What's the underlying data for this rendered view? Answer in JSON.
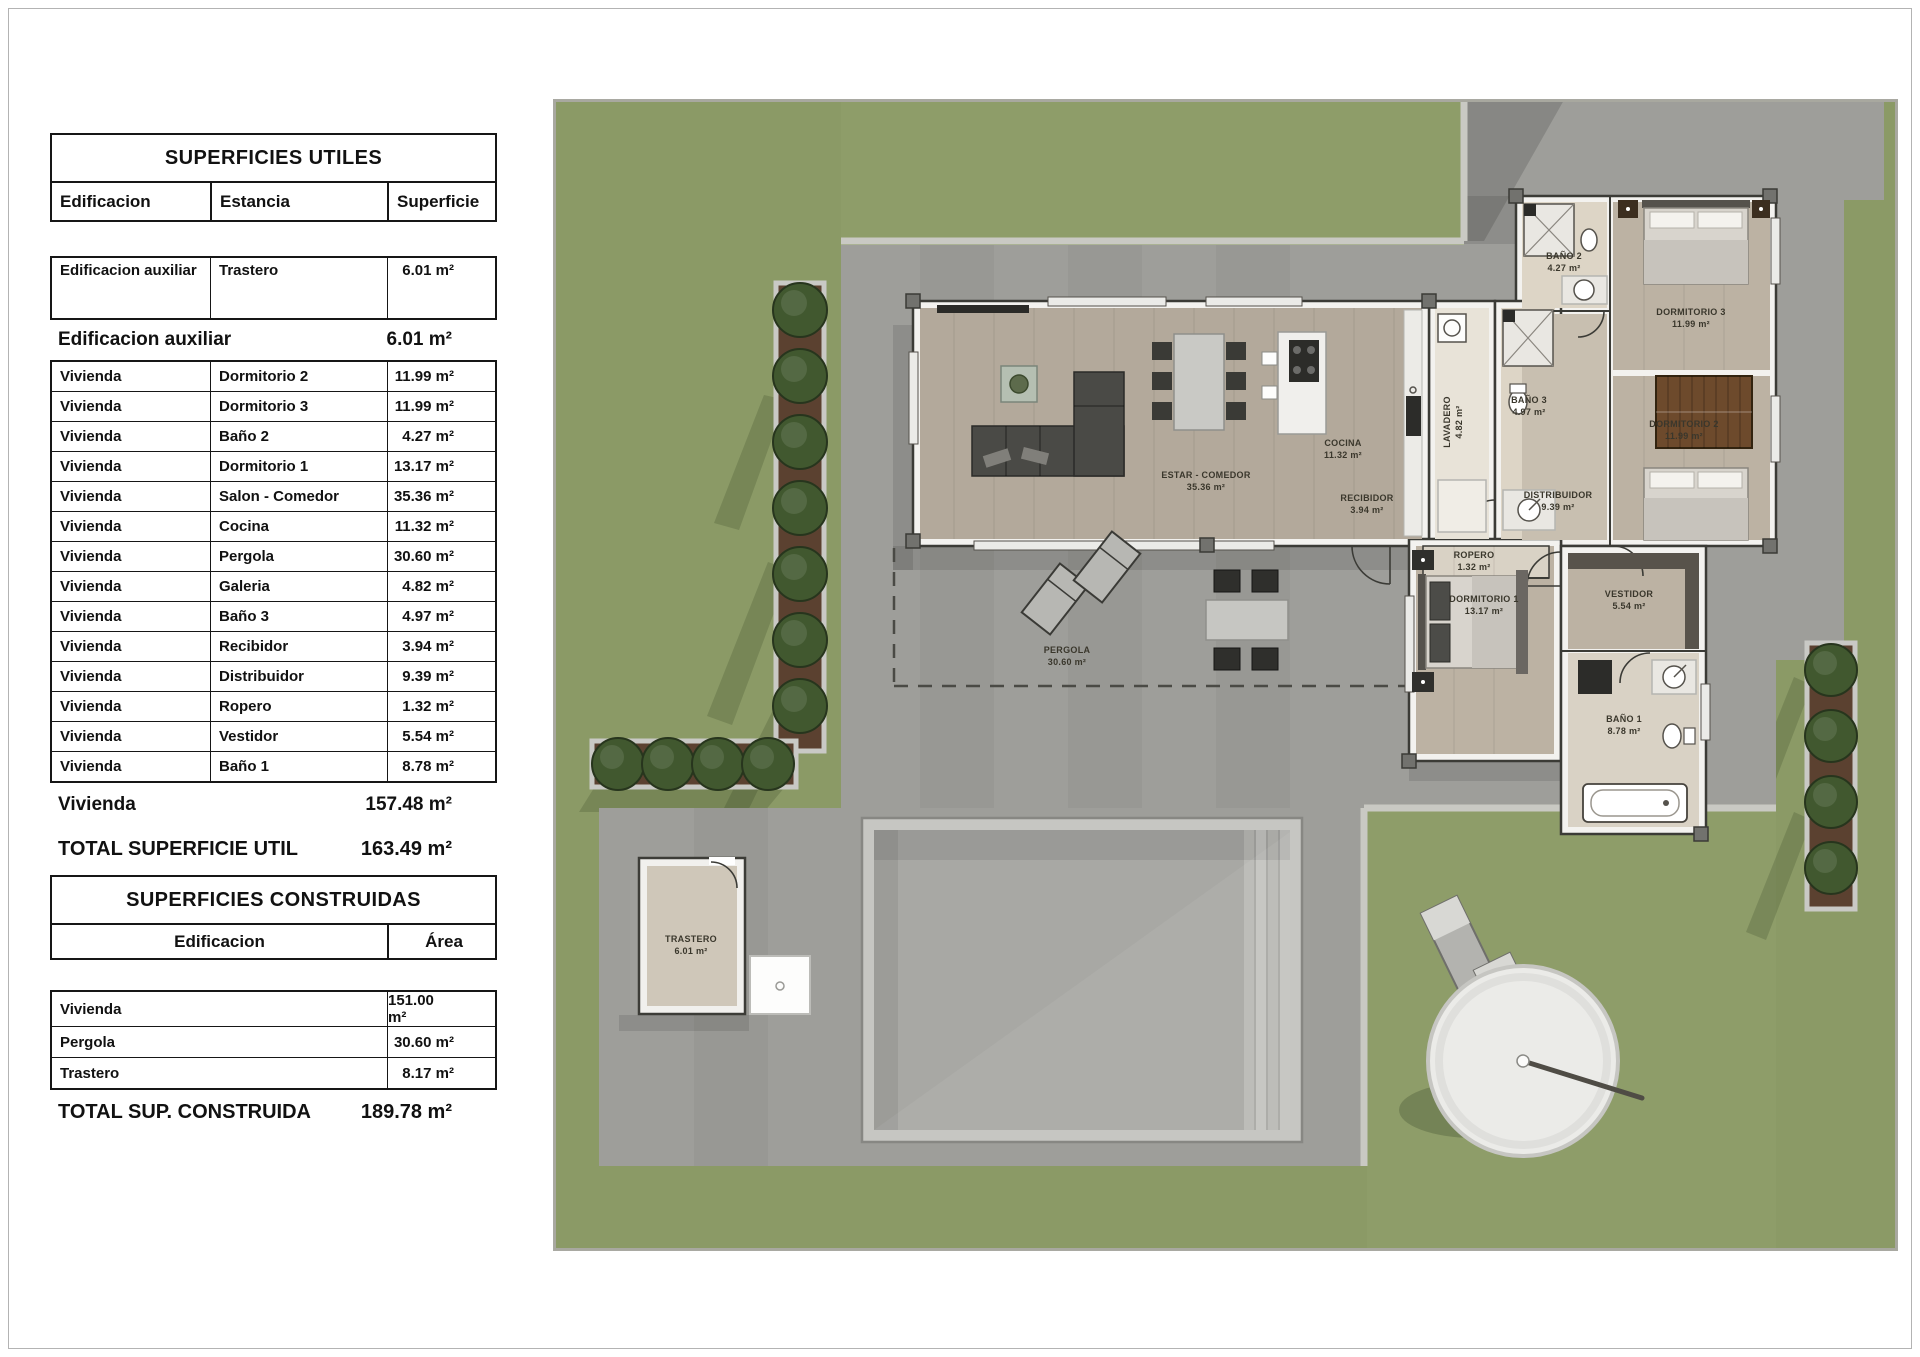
{
  "tables": {
    "utiles": {
      "title": "SUPERFICIES UTILES",
      "columns": [
        "Edificacion",
        "Estancia",
        "Superficie"
      ],
      "first_row": {
        "edificacion": "Edificacion auxiliar",
        "estancia": "Trastero",
        "superficie": "6.01 m²"
      },
      "subtotal_aux": {
        "label": "Edificacion auxiliar",
        "value": "6.01 m²"
      },
      "rows": [
        {
          "edificacion": "Vivienda",
          "estancia": "Dormitorio 2",
          "superficie": "11.99 m²"
        },
        {
          "edificacion": "Vivienda",
          "estancia": "Dormitorio 3",
          "superficie": "11.99 m²"
        },
        {
          "edificacion": "Vivienda",
          "estancia": "Baño 2",
          "superficie": "4.27 m²"
        },
        {
          "edificacion": "Vivienda",
          "estancia": "Dormitorio 1",
          "superficie": "13.17 m²"
        },
        {
          "edificacion": "Vivienda",
          "estancia": "Salon - Comedor",
          "superficie": "35.36 m²"
        },
        {
          "edificacion": "Vivienda",
          "estancia": "Cocina",
          "superficie": "11.32 m²"
        },
        {
          "edificacion": "Vivienda",
          "estancia": "Pergola",
          "superficie": "30.60 m²"
        },
        {
          "edificacion": "Vivienda",
          "estancia": "Galeria",
          "superficie": "4.82 m²"
        },
        {
          "edificacion": "Vivienda",
          "estancia": "Baño 3",
          "superficie": "4.97 m²"
        },
        {
          "edificacion": "Vivienda",
          "estancia": "Recibidor",
          "superficie": "3.94 m²"
        },
        {
          "edificacion": "Vivienda",
          "estancia": "Distribuidor",
          "superficie": "9.39 m²"
        },
        {
          "edificacion": "Vivienda",
          "estancia": "Ropero",
          "superficie": "1.32 m²"
        },
        {
          "edificacion": "Vivienda",
          "estancia": "Vestidor",
          "superficie": "5.54 m²"
        },
        {
          "edificacion": "Vivienda",
          "estancia": "Baño 1",
          "superficie": "8.78 m²"
        }
      ],
      "subtotal_vivienda": {
        "label": "Vivienda",
        "value": "157.48 m²"
      },
      "total": {
        "label": "TOTAL SUPERFICIE UTIL",
        "value": "163.49 m²"
      }
    },
    "construidas": {
      "title": "SUPERFICIES CONSTRUIDAS",
      "columns": [
        "Edificacion",
        "Área"
      ],
      "rows": [
        {
          "edificacion": "Vivienda",
          "area": "151.00 m²"
        },
        {
          "edificacion": "Pergola",
          "area": "30.60 m²"
        },
        {
          "edificacion": "Trastero",
          "area": "8.17 m²"
        }
      ],
      "total": {
        "label": "TOTAL SUP. CONSTRUIDA",
        "value": "189.78 m²"
      }
    }
  },
  "plan": {
    "colors": {
      "grass": "#8b9a66",
      "paving": "#9e9e9a",
      "wall": "#f3f2ef",
      "wood_floor": "#b3a99b",
      "bath_floor": "#ddd5c6",
      "tree": "#41582f",
      "planter": "#5b4130",
      "pool_water": "#a8a8a4"
    },
    "rooms": [
      {
        "label": "ESTAR - COMEDOR",
        "area": "35.36 m²"
      },
      {
        "label": "COCINA",
        "area": "11.32 m²"
      },
      {
        "label": "LAVADERO",
        "area": "4.82 m²"
      },
      {
        "label": "BAÑO 3",
        "area": "4.97 m²"
      },
      {
        "label": "RECIBIDOR",
        "area": "3.94 m²"
      },
      {
        "label": "DISTRIBUIDOR",
        "area": "9.39 m²"
      },
      {
        "label": "ROPERO",
        "area": "1.32 m²"
      },
      {
        "label": "DORMITORIO 1",
        "area": "13.17 m²"
      },
      {
        "label": "VESTIDOR",
        "area": "5.54 m²"
      },
      {
        "label": "BAÑO 1",
        "area": "8.78 m²"
      },
      {
        "label": "BAÑO 2",
        "area": "4.27 m²"
      },
      {
        "label": "DORMITORIO 3",
        "area": "11.99 m²"
      },
      {
        "label": "DORMITORIO 2",
        "area": "11.99 m²"
      },
      {
        "label": "PERGOLA",
        "area": "30.60 m²"
      },
      {
        "label": "TRASTERO",
        "area": "6.01 m²"
      }
    ]
  }
}
